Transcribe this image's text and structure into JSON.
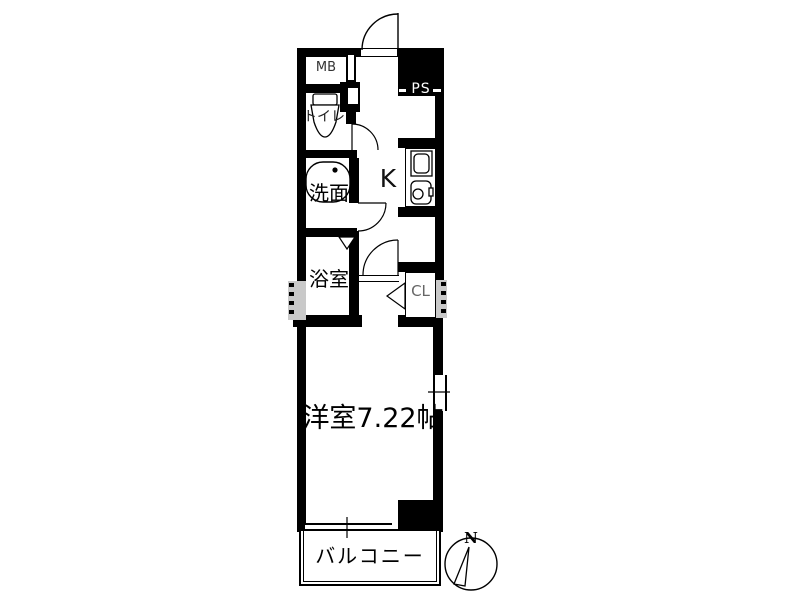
{
  "floorplan": {
    "labels": {
      "meter_box": "MB",
      "pipe_space": "PS",
      "toilet": "トイレ",
      "washroom": "洗面",
      "bathroom": "浴室",
      "kitchen": "K",
      "closet": "CL",
      "western_room": "洋室7.22帖",
      "balcony": "バルコニー",
      "compass_north": "N"
    },
    "colors": {
      "wall": "#000000",
      "background": "#ffffff",
      "boundary_hatch": "#c9c9c9",
      "muted_label": "#666666"
    }
  }
}
